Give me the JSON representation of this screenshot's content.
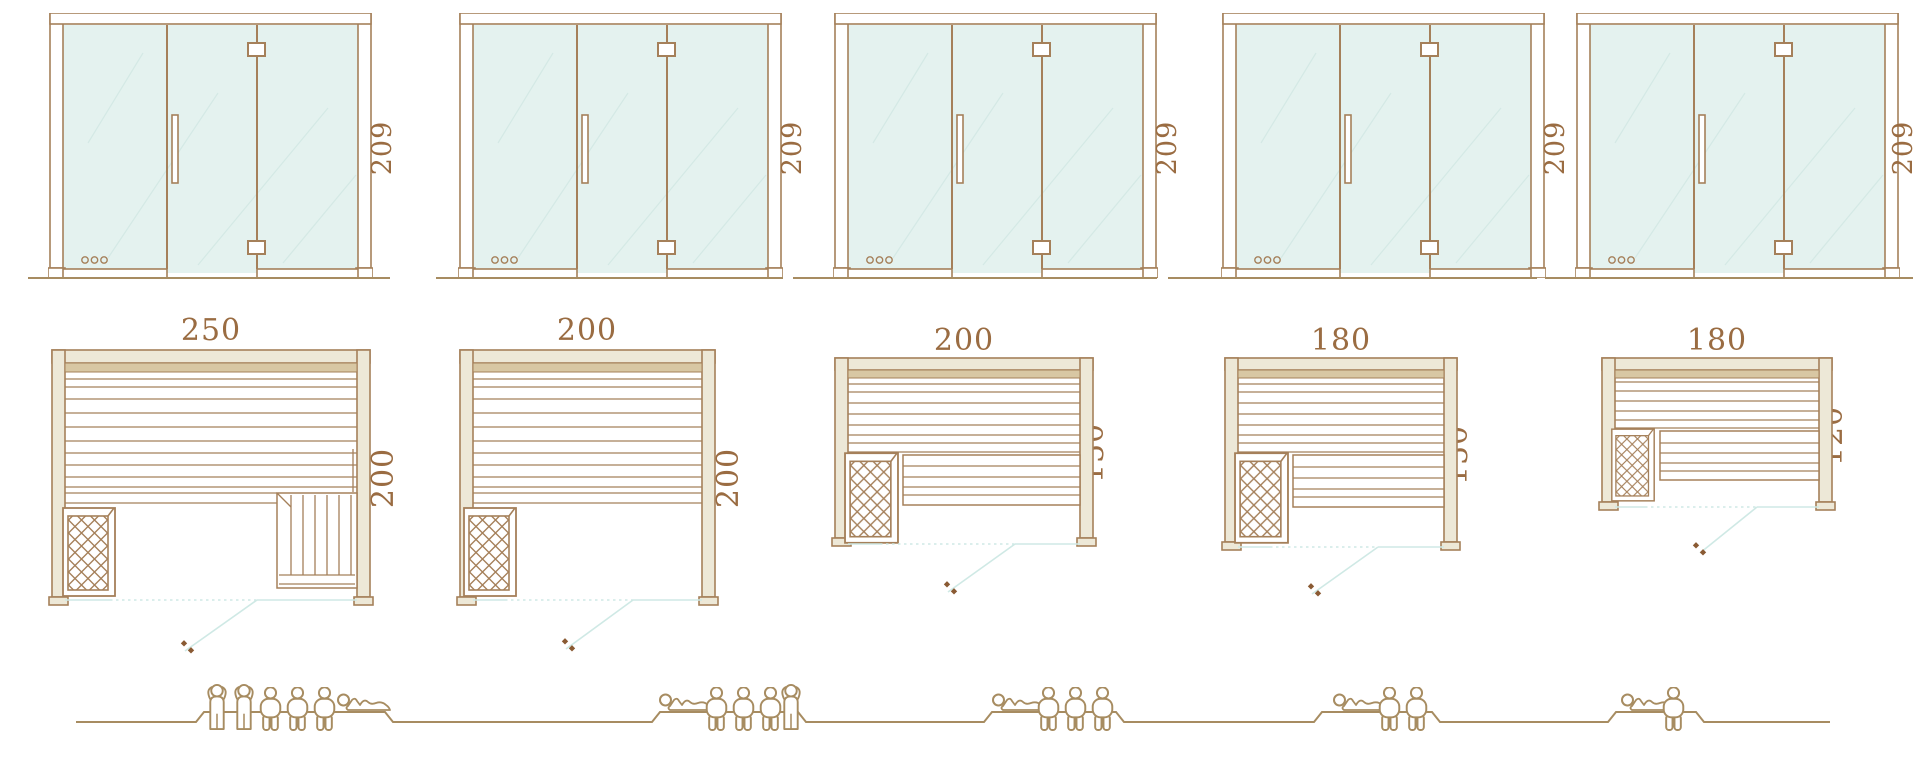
{
  "diagram": {
    "kind": "sauna-size-comparison",
    "palette": {
      "line_brown": "#a5805a",
      "text_brown": "#9a6c42",
      "glass_fill": "#e4f2ef",
      "glass_streak": "#d4e9e5",
      "wall_fill": "#ede8d7",
      "wood_strip": "#d8c7a3",
      "door_teal": "#cfe9e5",
      "handle_dot": "#8a5a33",
      "people_brown": "#a78c61"
    },
    "rows": {
      "top": "front elevations of glass door wall",
      "middle": "floor plans with dimensions (cm)",
      "bottom": "seating capacity pictograms"
    }
  },
  "units": [
    {
      "name": "sauna-250x200",
      "elevation": {
        "height_label": "209"
      },
      "plan": {
        "width_label": "250",
        "depth_label": "200"
      },
      "capacity": {
        "standing": 2,
        "sitting": 3,
        "lying": 1,
        "total": 6
      }
    },
    {
      "name": "sauna-200x200",
      "elevation": {
        "height_label": "209"
      },
      "plan": {
        "width_label": "200",
        "depth_label": "200"
      },
      "capacity": {
        "standing": 1,
        "sitting": 3,
        "lying": 1,
        "total": 5
      }
    },
    {
      "name": "sauna-200x150",
      "elevation": {
        "height_label": "209"
      },
      "plan": {
        "width_label": "200",
        "depth_label": "150"
      },
      "capacity": {
        "standing": 0,
        "sitting": 3,
        "lying": 1,
        "total": 4
      }
    },
    {
      "name": "sauna-180x150",
      "elevation": {
        "height_label": "209"
      },
      "plan": {
        "width_label": "180",
        "depth_label": "150"
      },
      "capacity": {
        "standing": 0,
        "sitting": 2,
        "lying": 1,
        "total": 3
      }
    },
    {
      "name": "sauna-180x120",
      "elevation": {
        "height_label": "209"
      },
      "plan": {
        "width_label": "180",
        "depth_label": "120"
      },
      "capacity": {
        "standing": 0,
        "sitting": 1,
        "lying": 1,
        "total": 2
      }
    }
  ]
}
